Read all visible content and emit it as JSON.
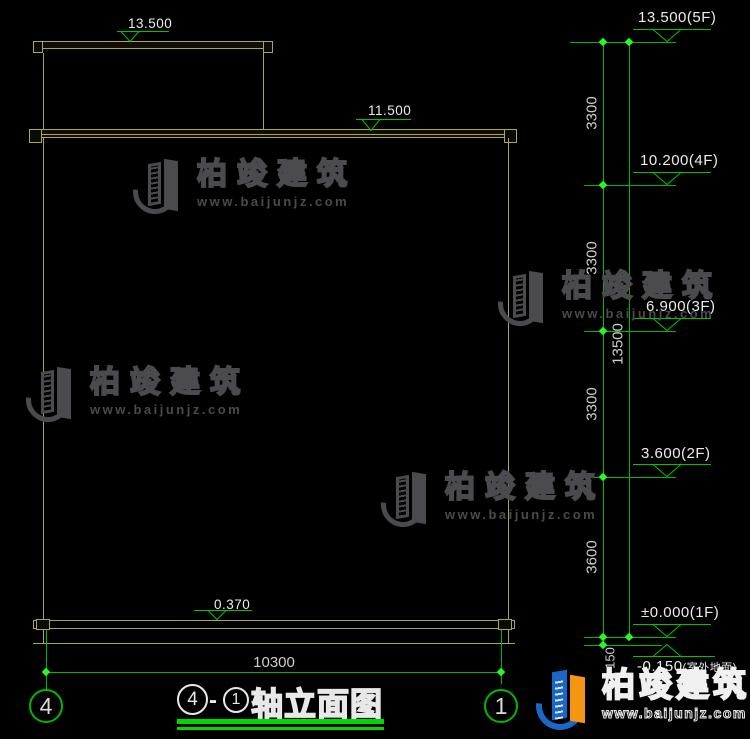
{
  "colors": {
    "background": "#000000",
    "building_line": "#a8a65c",
    "dim_line_green": "#00b800",
    "tick_green": "#22ff22",
    "marker_green": "#00c400",
    "text_light": "#d9d9d9",
    "title_underline_green": "#00d800",
    "watermark_gray": "#4a4a4f",
    "logo_blue": "#1a67c8",
    "logo_orange": "#f59511"
  },
  "markers_left": [
    {
      "value": "13.500"
    },
    {
      "value": "11.500"
    },
    {
      "value": "0.370"
    }
  ],
  "markers_right": [
    {
      "value": "13.500",
      "suffix": "(5F)"
    },
    {
      "value": "10.200",
      "suffix": "(4F)"
    },
    {
      "value": "6.900",
      "suffix": "(3F)"
    },
    {
      "value": "3.600",
      "suffix": "(2F)"
    },
    {
      "value": "±0.000",
      "suffix": "(1F)"
    },
    {
      "value": "-0.150",
      "suffix": "(室外地面)"
    }
  ],
  "vertical_dimensions": {
    "segments": [
      "3300",
      "3300",
      "3300",
      "3600",
      "150"
    ],
    "total": "13500"
  },
  "horizontal_dimension": "10300",
  "axis_bubbles": {
    "left": "4",
    "right": "1"
  },
  "title": {
    "start": "4",
    "separator": "-",
    "end": "1",
    "name": "轴立面图"
  },
  "watermark": {
    "brand": "柏竣建筑",
    "site": "www.baijunjz.com"
  },
  "corner_logo": {
    "brand": "柏竣建筑",
    "site": "www.baijunjz.com"
  }
}
